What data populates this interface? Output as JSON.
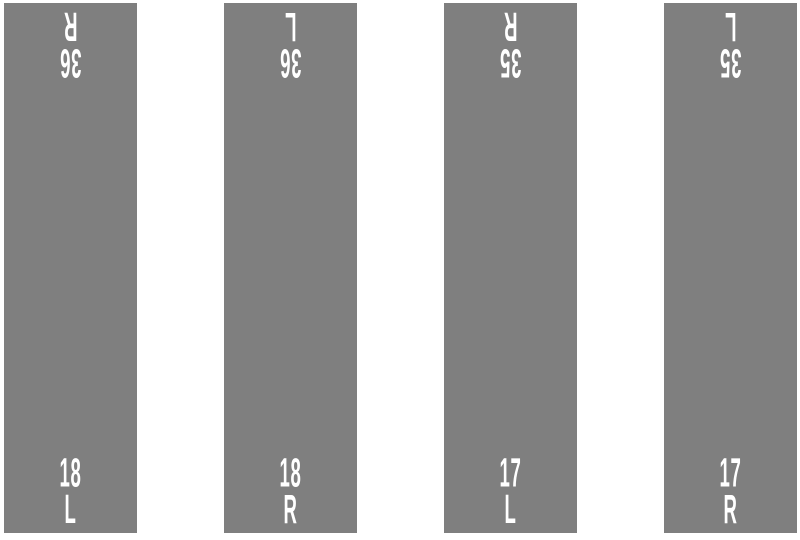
{
  "colors": {
    "background": "#ffffff",
    "runway_surface": "#7f7f7f",
    "marking_text": "#ffffff"
  },
  "runways": [
    {
      "top": {
        "number": "36",
        "letter": "R"
      },
      "bottom": {
        "number": "18",
        "letter": "L"
      }
    },
    {
      "top": {
        "number": "36",
        "letter": "L"
      },
      "bottom": {
        "number": "18",
        "letter": "R"
      }
    },
    {
      "top": {
        "number": "35",
        "letter": "R"
      },
      "bottom": {
        "number": "17",
        "letter": "L"
      }
    },
    {
      "top": {
        "number": "35",
        "letter": "L"
      },
      "bottom": {
        "number": "17",
        "letter": "R"
      }
    }
  ]
}
